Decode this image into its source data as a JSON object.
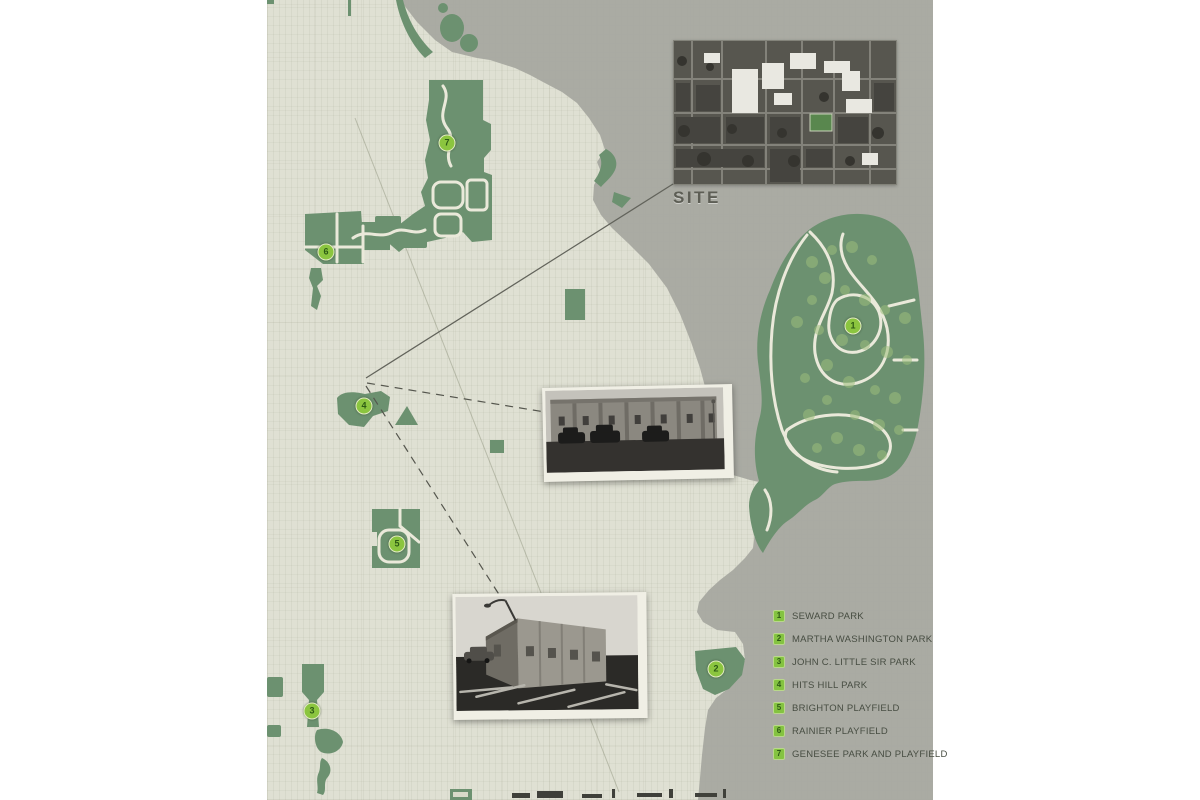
{
  "map": {
    "site_label": "SITE",
    "legend": {
      "items": [
        {
          "number": "1",
          "label": "SEWARD PARK"
        },
        {
          "number": "2",
          "label": "MARTHA WASHINGTON PARK"
        },
        {
          "number": "3",
          "label": "JOHN C. LITTLE SIR PARK"
        },
        {
          "number": "4",
          "label": "HITS HILL PARK"
        },
        {
          "number": "5",
          "label": "BRIGHTON PLAYFIELD"
        },
        {
          "number": "6",
          "label": "RAINIER PLAYFIELD"
        },
        {
          "number": "7",
          "label": "GENESEE PARK AND PLAYFIELD"
        }
      ]
    },
    "markers": [
      {
        "number": "1",
        "name": "seward-park",
        "x": 586,
        "y": 326
      },
      {
        "number": "2",
        "name": "martha-washington-park",
        "x": 449,
        "y": 669
      },
      {
        "number": "3",
        "name": "john-c-little-sir-park",
        "x": 45,
        "y": 711
      },
      {
        "number": "4",
        "name": "hits-hill-park",
        "x": 97,
        "y": 406
      },
      {
        "number": "5",
        "name": "brighton-playfield",
        "x": 130,
        "y": 544
      },
      {
        "number": "6",
        "name": "rainier-playfield",
        "x": 59,
        "y": 252
      },
      {
        "number": "7",
        "name": "genesee-park-and-playfield",
        "x": 180,
        "y": 143
      }
    ],
    "colors": {
      "land": "#dfe0d3",
      "water": "#a6a8a0",
      "park_green": "#6c9170",
      "accent_green": "#8bc53f",
      "path_cream": "#eae9da",
      "text": "#474d42"
    }
  }
}
